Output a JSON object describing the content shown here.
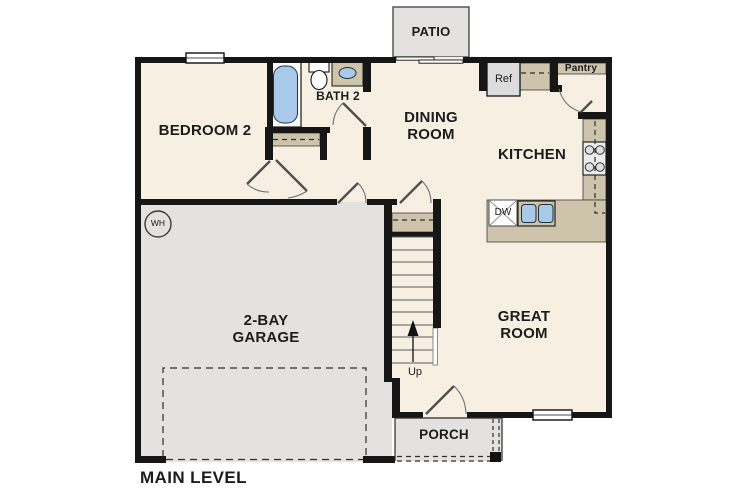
{
  "title": {
    "main_level": "MAIN LEVEL"
  },
  "rooms": {
    "bedroom2": "BEDROOM 2",
    "bath2": "BATH 2",
    "dining_room": "DINING ROOM",
    "kitchen": "KITCHEN",
    "great_room": "GREAT ROOM",
    "garage": "2-BAY GARAGE",
    "patio": "PATIO",
    "porch": "PORCH",
    "pantry": "Pantry"
  },
  "fixtures": {
    "refrigerator": "Ref",
    "dishwasher": "DW",
    "water_heater": "WH",
    "stairs_direction": "Up"
  },
  "colors": {
    "wall": "#161616",
    "floor": "#f7efe2",
    "hard_surface": "#e3e2e0",
    "counter": "#cec3ab",
    "water_fixture": "#a9c9e9",
    "appliance": "#dcdcdc",
    "fixture_white": "#ffffff",
    "background": "#ffffff"
  }
}
